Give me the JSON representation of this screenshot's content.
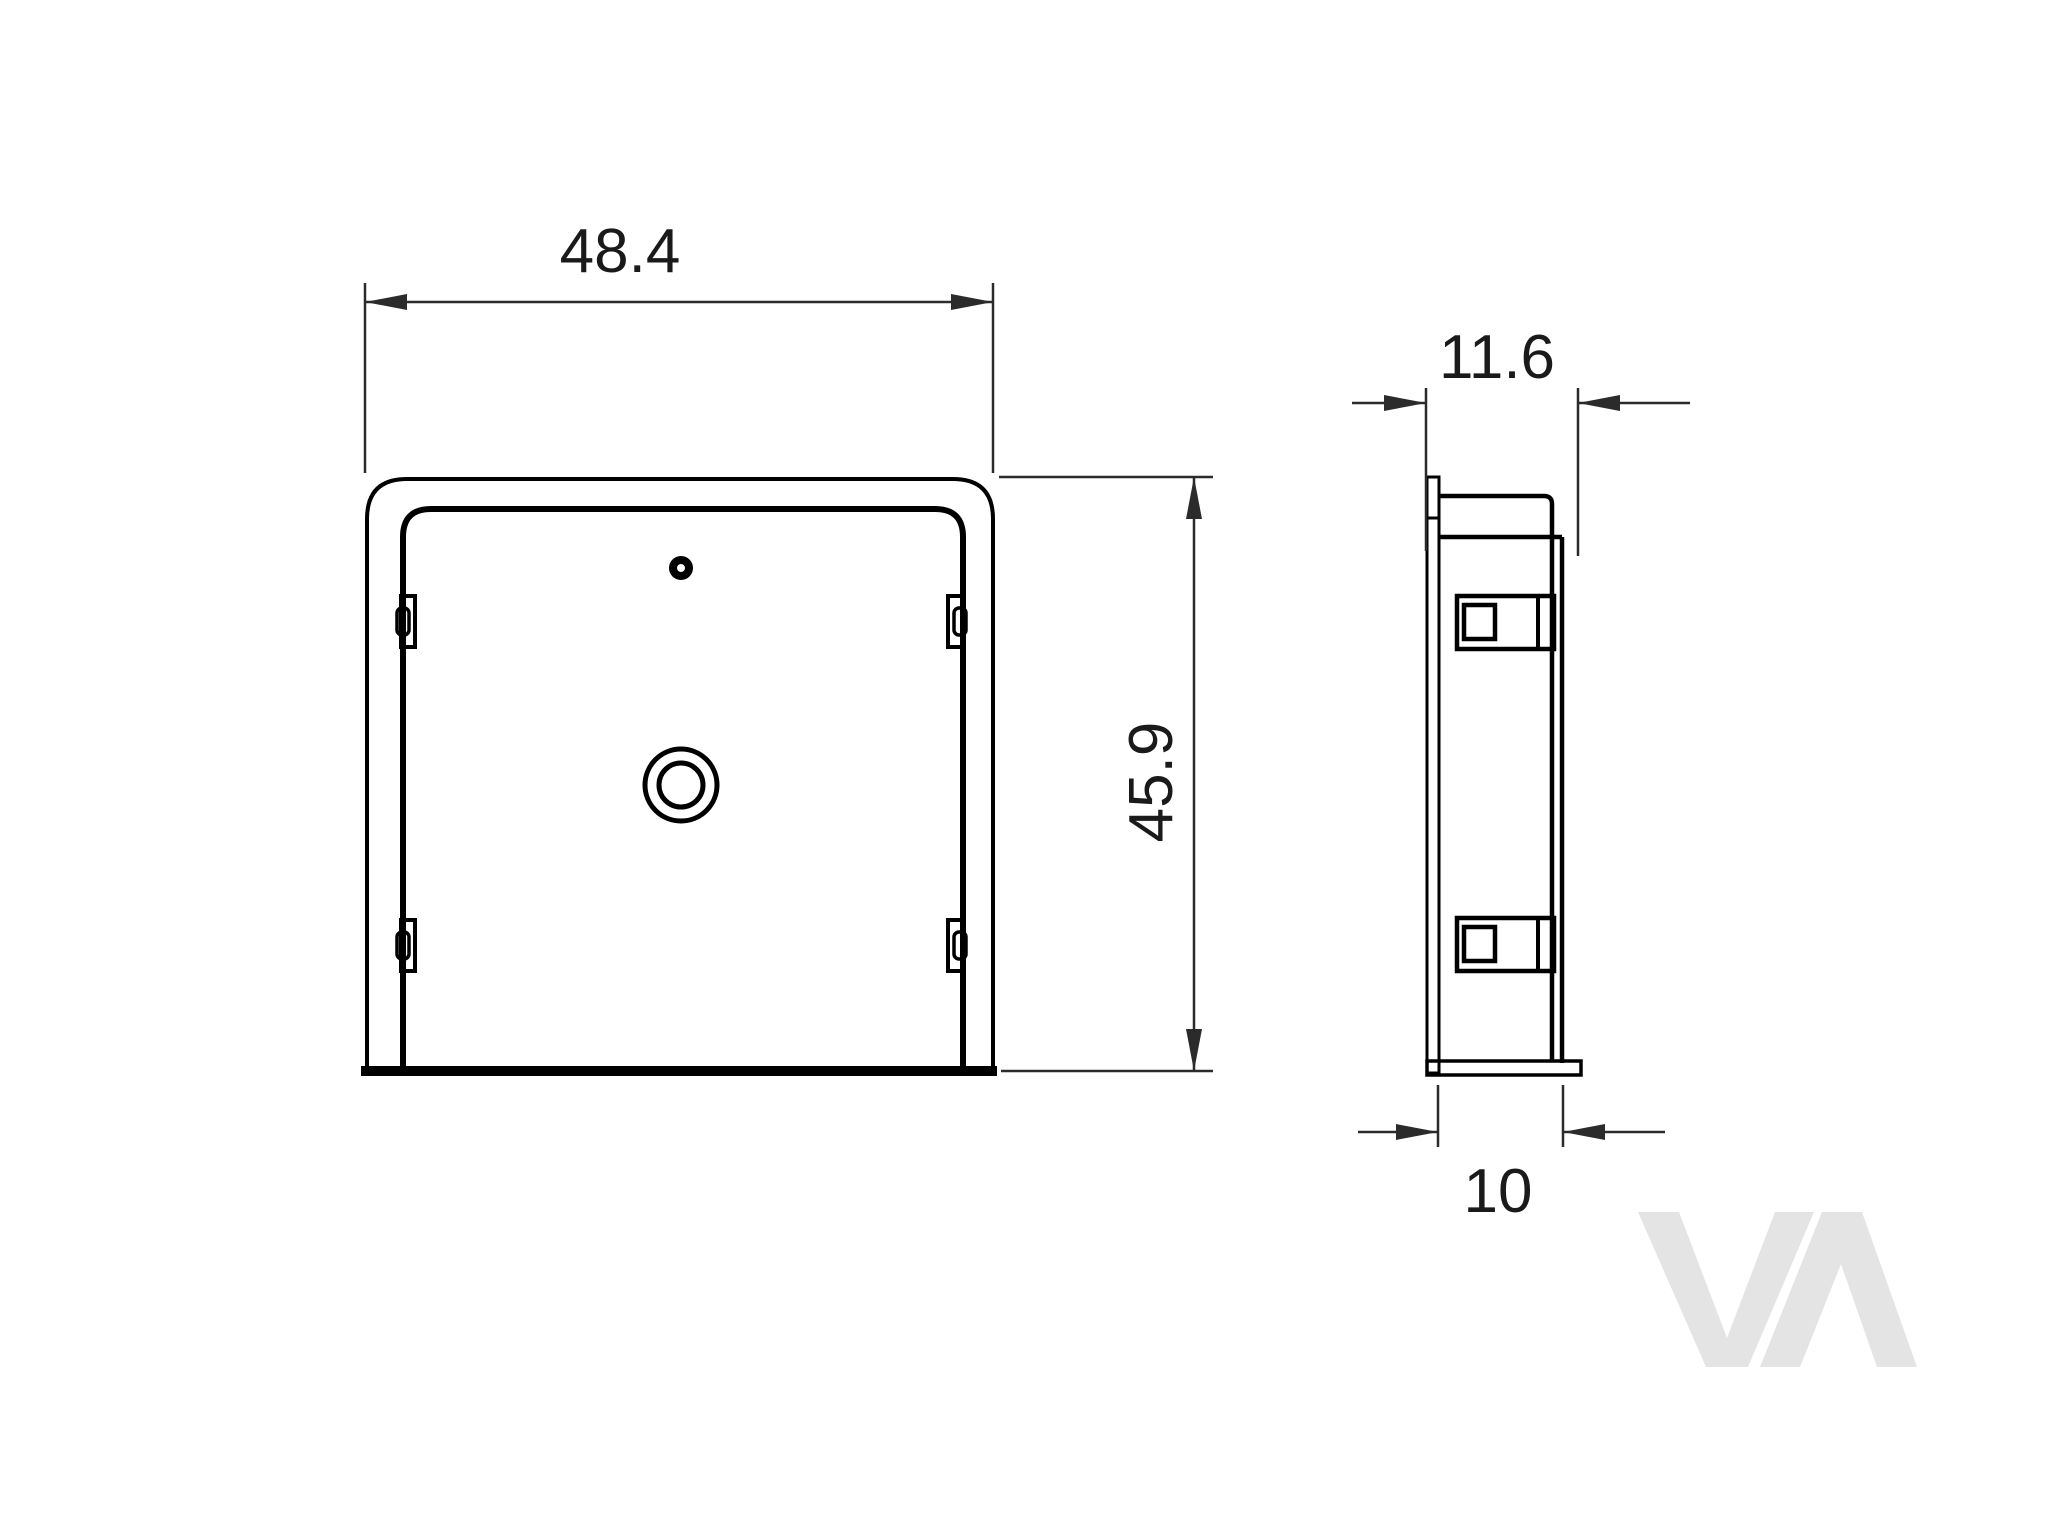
{
  "drawing": {
    "front_view": {
      "width_dim": {
        "label": "48.4"
      },
      "height_dim": {
        "label": "45.9"
      }
    },
    "side_view": {
      "overall_depth_dim": {
        "label": "11.6"
      },
      "body_depth_dim": {
        "label": "10"
      }
    },
    "watermark": {
      "text": "VA"
    },
    "colors": {
      "background": "#ffffff",
      "part": "#000000",
      "dimension": "#2b2b2b",
      "text": "#1a1a1a",
      "watermark": "#e4e4e4"
    }
  }
}
